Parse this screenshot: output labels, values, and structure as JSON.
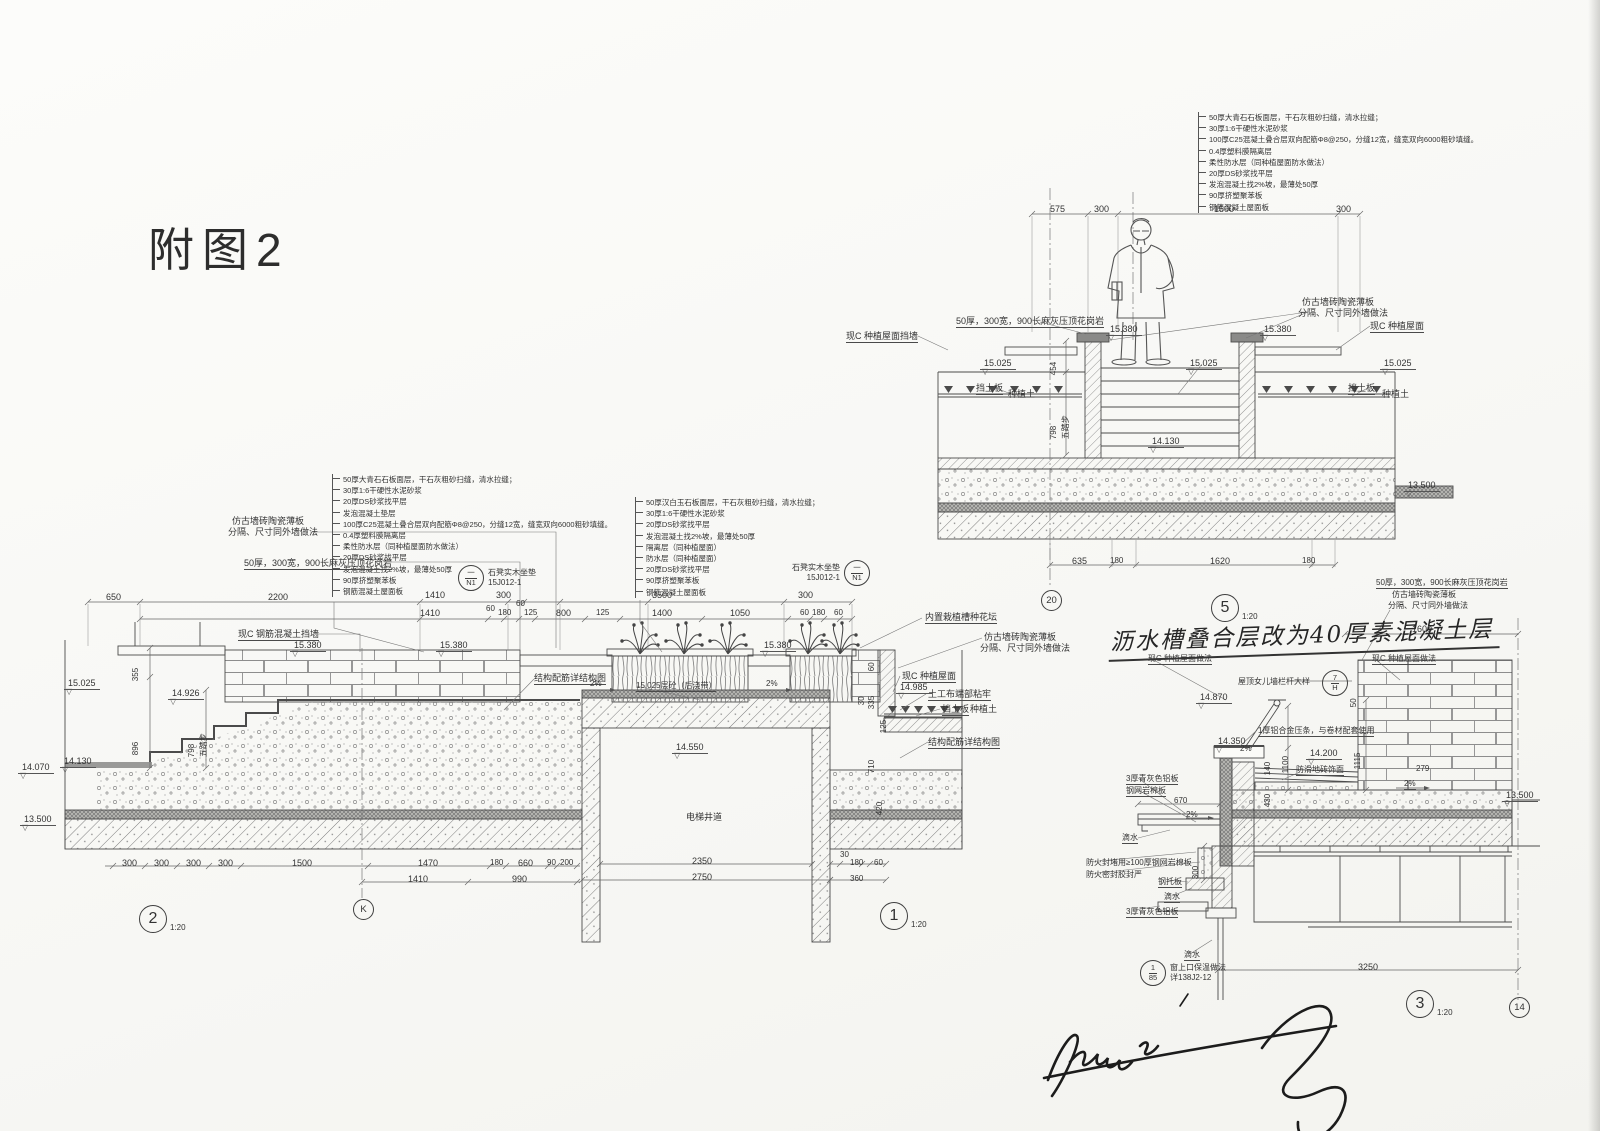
{
  "title": "附图2",
  "colors": {
    "paper": "#fbfbf8",
    "ink": "#4b4b4b",
    "ink_dark": "#2d2d2d"
  },
  "layer_stacks": {
    "stack_a": [
      "50厚大青石石板面层，干石灰粗砂扫缝，清水拉缝；",
      "30厚1:6干硬性水泥砂浆",
      "20厚DS砂浆找平层",
      "发泡混凝土垫层",
      "100厚C25混凝土叠合层双向配筋Φ8@250，分缝12宽，缝宽双向6000粗砂填缝。",
      "0.4厚塑料膜隔离层",
      "柔性防水层（同种植屋面防水做法）",
      "20厚DS砂浆找平层",
      "发泡混凝土找2%坡，最薄处50厚",
      "90厚挤塑聚苯板",
      "钢筋混凝土屋面板"
    ],
    "stack_b": [
      "50厚汉白玉石板面层，干石灰粗砂扫缝，清水拉缝；",
      "30厚1:6干硬性水泥砂浆",
      "20厚DS砂浆找平层",
      "发泡混凝土找2%坡，最薄处50厚",
      "隔离层（同种植屋面）",
      "防水层（同种植屋面）",
      "20厚DS砂浆找平层",
      "90厚挤塑聚苯板",
      "钢筋混凝土屋面板"
    ],
    "stack_c": [
      "50厚大青石石板面层，干石灰粗砂扫缝，清水拉缝；",
      "30厚1:6干硬性水泥砂浆",
      "100厚C25混凝土叠合层双向配筋Φ8@250，分缝12宽，缝宽双向6000粗砂填缝。",
      "0.4厚塑料膜隔离层",
      "柔性防水层（同种植屋面防水做法）",
      "20厚DS砂浆找平层",
      "发泡混凝土找2%坡，最薄处50厚",
      "90厚挤塑聚苯板",
      "钢筋混凝土屋面板"
    ]
  },
  "details": {
    "d2": {
      "num": "2",
      "scale": "1:20"
    },
    "d1": {
      "num": "1",
      "scale": "1:20"
    },
    "d5": {
      "num": "5",
      "scale": "1:20"
    },
    "d3": {
      "num": "3",
      "scale": "1:20"
    }
  },
  "grids": {
    "k": "K",
    "g20": "20",
    "g14": "14"
  },
  "callouts": {
    "bench": {
      "top": "一",
      "bottom": "N1",
      "label": "石凳实木坐垫",
      "ref": "15J012-1"
    },
    "parapet": {
      "top": "7",
      "bottom": "H"
    },
    "window": {
      "top": "1",
      "bottom": "85",
      "label": "窗上口保温做法",
      "ref": "详138J2-12"
    }
  },
  "note": {
    "text": "沥水槽叠合层改为40厚素混凝土层"
  },
  "annotations": [
    {
      "n": "dim",
      "t": "650",
      "x": 106,
      "y": 592
    },
    {
      "n": "dim",
      "t": "2200",
      "x": 268,
      "y": 592
    },
    {
      "n": "dim",
      "t": "1410",
      "x": 425,
      "y": 590
    },
    {
      "n": "dim",
      "t": "300",
      "x": 496,
      "y": 590
    },
    {
      "n": "dim",
      "t": "3500",
      "x": 652,
      "y": 590
    },
    {
      "n": "dim",
      "t": "300",
      "x": 798,
      "y": 590
    },
    {
      "n": "dim",
      "t": "1410",
      "x": 420,
      "y": 608
    },
    {
      "n": "dim",
      "t": "60",
      "x": 486,
      "y": 604,
      "c": "small"
    },
    {
      "n": "dim",
      "t": "180",
      "x": 498,
      "y": 608,
      "c": "small"
    },
    {
      "n": "dim",
      "t": "60",
      "x": 516,
      "y": 599,
      "c": "small"
    },
    {
      "n": "dim",
      "t": "125",
      "x": 524,
      "y": 608,
      "c": "small"
    },
    {
      "n": "dim",
      "t": "800",
      "x": 556,
      "y": 608
    },
    {
      "n": "dim",
      "t": "125",
      "x": 596,
      "y": 608,
      "c": "small"
    },
    {
      "n": "dim",
      "t": "1400",
      "x": 652,
      "y": 608
    },
    {
      "n": "dim",
      "t": "1050",
      "x": 730,
      "y": 608
    },
    {
      "n": "dim",
      "t": "60",
      "x": 800,
      "y": 608,
      "c": "small"
    },
    {
      "n": "dim",
      "t": "180",
      "x": 812,
      "y": 608,
      "c": "small"
    },
    {
      "n": "dim",
      "t": "60",
      "x": 834,
      "y": 608,
      "c": "small"
    },
    {
      "n": "label-tile-panel",
      "t": "仿古墙砖陶瓷薄板",
      "x": 232,
      "y": 516
    },
    {
      "n": "label-tile-panel",
      "t": "分隔、尺寸同外墙做法",
      "x": 228,
      "y": 527
    },
    {
      "n": "label-coping",
      "t": "50厚，300宽，900长麻灰压顶花岗岩",
      "x": 244,
      "y": 558,
      "c": "u"
    },
    {
      "n": "label-wall",
      "t": "现C 钢筋混凝土挡墙",
      "x": 238,
      "y": 629,
      "c": "u"
    },
    {
      "n": "elevation",
      "t": "15.380",
      "x": 290,
      "y": 640,
      "c": "elev"
    },
    {
      "n": "elevation",
      "t": "15.380",
      "x": 436,
      "y": 640,
      "c": "elev"
    },
    {
      "n": "elevation",
      "t": "15.380",
      "x": 760,
      "y": 640,
      "c": "elev"
    },
    {
      "n": "elevation",
      "t": "15.025",
      "x": 64,
      "y": 678,
      "c": "elev"
    },
    {
      "n": "elevation",
      "t": "14.926",
      "x": 168,
      "y": 688,
      "c": "elev"
    },
    {
      "n": "elevation",
      "t": "14.070",
      "x": 18,
      "y": 762,
      "c": "elev"
    },
    {
      "n": "elevation",
      "t": "14.130",
      "x": 60,
      "y": 756,
      "c": "elev"
    },
    {
      "n": "elevation",
      "t": "13.500",
      "x": 20,
      "y": 814,
      "c": "elev"
    },
    {
      "n": "elevation",
      "t": "14.550",
      "x": 672,
      "y": 742,
      "c": "elev"
    },
    {
      "n": "elevation",
      "t": "14.985",
      "x": 896,
      "y": 682,
      "c": "elev"
    },
    {
      "n": "dim",
      "t": "355",
      "x": 140,
      "y": 672,
      "c": "rot small"
    },
    {
      "n": "dim",
      "t": "896",
      "x": 140,
      "y": 746,
      "c": "rot small"
    },
    {
      "n": "dim",
      "t": "798",
      "x": 196,
      "y": 748,
      "c": "rot small"
    },
    {
      "n": "dim",
      "t": "五踏步",
      "x": 208,
      "y": 748,
      "c": "rot small"
    },
    {
      "n": "label-planter",
      "t": "内置栽植槽种花坛",
      "x": 925,
      "y": 612,
      "c": "u"
    },
    {
      "n": "label-tile-panel",
      "t": "仿古墙砖陶瓷薄板",
      "x": 984,
      "y": 632
    },
    {
      "n": "label-tile-panel",
      "t": "分隔、尺寸同外墙做法",
      "x": 980,
      "y": 643
    },
    {
      "n": "label-green-roof",
      "t": "现C 种植屋面",
      "x": 902,
      "y": 671,
      "c": "u"
    },
    {
      "n": "label-geotextile",
      "t": "土工布端部粘牢",
      "x": 928,
      "y": 689,
      "c": "u"
    },
    {
      "n": "label-soil-board",
      "t": "挡土板",
      "x": 942,
      "y": 704,
      "c": "u"
    },
    {
      "n": "label-soil",
      "t": "种植土",
      "x": 970,
      "y": 704
    },
    {
      "n": "label-rebar",
      "t": "结构配筋详结构图",
      "x": 928,
      "y": 737,
      "c": "u"
    },
    {
      "n": "label-rebar",
      "t": "结构配筋详结构图",
      "x": 534,
      "y": 673,
      "c": "u"
    },
    {
      "n": "label-pour-strip",
      "t": "15.025层砼（后浇带）",
      "x": 636,
      "y": 681,
      "c": "u small"
    },
    {
      "n": "slope",
      "t": "2%",
      "x": 590,
      "y": 679,
      "c": "small"
    },
    {
      "n": "slope",
      "t": "2%",
      "x": 766,
      "y": 679,
      "c": "small"
    },
    {
      "n": "elevator-shaft-label",
      "t": "电梯井道",
      "x": 686,
      "y": 812
    },
    {
      "n": "dim",
      "t": "335",
      "x": 876,
      "y": 700,
      "c": "rot small"
    },
    {
      "n": "dim",
      "t": "60",
      "x": 876,
      "y": 662,
      "c": "rot small"
    },
    {
      "n": "dim",
      "t": "30",
      "x": 866,
      "y": 696,
      "c": "rot small"
    },
    {
      "n": "dim",
      "t": "125",
      "x": 888,
      "y": 724,
      "c": "rot small"
    },
    {
      "n": "dim",
      "t": "710",
      "x": 876,
      "y": 764,
      "c": "rot small"
    },
    {
      "n": "dim",
      "t": "420",
      "x": 884,
      "y": 806,
      "c": "rot small"
    },
    {
      "n": "dim",
      "t": "300",
      "x": 122,
      "y": 858
    },
    {
      "n": "dim",
      "t": "300",
      "x": 154,
      "y": 858
    },
    {
      "n": "dim",
      "t": "300",
      "x": 186,
      "y": 858
    },
    {
      "n": "dim",
      "t": "300",
      "x": 218,
      "y": 858
    },
    {
      "n": "dim",
      "t": "1500",
      "x": 292,
      "y": 858
    },
    {
      "n": "dim",
      "t": "1470",
      "x": 418,
      "y": 858
    },
    {
      "n": "dim",
      "t": "180",
      "x": 490,
      "y": 858,
      "c": "small"
    },
    {
      "n": "dim",
      "t": "660",
      "x": 518,
      "y": 858
    },
    {
      "n": "dim",
      "t": "90",
      "x": 547,
      "y": 858,
      "c": "small"
    },
    {
      "n": "dim",
      "t": "200",
      "x": 560,
      "y": 858,
      "c": "small"
    },
    {
      "n": "dim",
      "t": "1410",
      "x": 408,
      "y": 874
    },
    {
      "n": "dim",
      "t": "990",
      "x": 512,
      "y": 874
    },
    {
      "n": "dim",
      "t": "2350",
      "x": 692,
      "y": 856
    },
    {
      "n": "dim",
      "t": "2750",
      "x": 692,
      "y": 872
    },
    {
      "n": "dim",
      "t": "30",
      "x": 840,
      "y": 850,
      "c": "small"
    },
    {
      "n": "dim",
      "t": "180",
      "x": 850,
      "y": 858,
      "c": "small"
    },
    {
      "n": "dim",
      "t": "60",
      "x": 874,
      "y": 858,
      "c": "small"
    },
    {
      "n": "dim",
      "t": "360",
      "x": 850,
      "y": 874,
      "c": "small"
    },
    {
      "n": "dim",
      "t": "575",
      "x": 1050,
      "y": 204
    },
    {
      "n": "dim",
      "t": "300",
      "x": 1094,
      "y": 204
    },
    {
      "n": "dim",
      "t": "1500",
      "x": 1214,
      "y": 204
    },
    {
      "n": "dim",
      "t": "300",
      "x": 1336,
      "y": 204
    },
    {
      "n": "label-coping",
      "t": "50厚，300宽，900长麻灰压顶花岗岩",
      "x": 956,
      "y": 316,
      "c": "u"
    },
    {
      "n": "elevation",
      "t": "15.380",
      "x": 1106,
      "y": 324,
      "c": "elev"
    },
    {
      "n": "elevation",
      "t": "15.380",
      "x": 1260,
      "y": 324,
      "c": "elev"
    },
    {
      "n": "elevation",
      "t": "15.025",
      "x": 980,
      "y": 358,
      "c": "elev"
    },
    {
      "n": "elevation",
      "t": "15.025",
      "x": 1186,
      "y": 358,
      "c": "elev"
    },
    {
      "n": "elevation",
      "t": "15.025",
      "x": 1380,
      "y": 358,
      "c": "elev"
    },
    {
      "n": "label-tile-panel",
      "t": "仿古墙砖陶瓷薄板",
      "x": 1302,
      "y": 297
    },
    {
      "n": "label-tile-panel",
      "t": "分隔、尺寸同外墙做法",
      "x": 1298,
      "y": 308
    },
    {
      "n": "label-wall",
      "t": "现C 种植屋面挡墙",
      "x": 846,
      "y": 331,
      "c": "u"
    },
    {
      "n": "label-green-roof",
      "t": "现C 种植屋面",
      "x": 1370,
      "y": 321,
      "c": "u"
    },
    {
      "n": "label-soil-board",
      "t": "挡土板",
      "x": 976,
      "y": 383,
      "c": "u"
    },
    {
      "n": "label-soil",
      "t": "种植土",
      "x": 1008,
      "y": 389
    },
    {
      "n": "label-soil-board",
      "t": "挡土板",
      "x": 1348,
      "y": 383,
      "c": "u"
    },
    {
      "n": "label-soil",
      "t": "种植土",
      "x": 1382,
      "y": 389
    },
    {
      "n": "dim",
      "t": "454",
      "x": 1058,
      "y": 366,
      "c": "rot small"
    },
    {
      "n": "dim",
      "t": "798",
      "x": 1058,
      "y": 430,
      "c": "rot small"
    },
    {
      "n": "dim",
      "t": "五踏步",
      "x": 1070,
      "y": 430,
      "c": "rot small"
    },
    {
      "n": "elevation",
      "t": "14.130",
      "x": 1148,
      "y": 436,
      "c": "elev"
    },
    {
      "n": "elevation",
      "t": "13.500",
      "x": 1404,
      "y": 480,
      "c": "elev"
    },
    {
      "n": "dim",
      "t": "635",
      "x": 1072,
      "y": 556
    },
    {
      "n": "dim",
      "t": "180",
      "x": 1110,
      "y": 556,
      "c": "small"
    },
    {
      "n": "dim",
      "t": "1620",
      "x": 1210,
      "y": 556
    },
    {
      "n": "dim",
      "t": "180",
      "x": 1302,
      "y": 556,
      "c": "small"
    },
    {
      "n": "label-coping",
      "t": "50厚，300宽，900长麻灰压顶花岗岩",
      "x": 1376,
      "y": 578,
      "c": "u small"
    },
    {
      "n": "label-tile-panel",
      "t": "仿古墙砖陶瓷薄板",
      "x": 1392,
      "y": 590,
      "c": "small"
    },
    {
      "n": "label-tile-panel",
      "t": "分隔、尺寸同外墙做法",
      "x": 1388,
      "y": 601,
      "c": "small"
    },
    {
      "n": "dim",
      "t": "1600",
      "x": 1412,
      "y": 624
    },
    {
      "n": "label-green-roof",
      "t": "现C 种植屋面做法",
      "x": 1148,
      "y": 654,
      "c": "u small"
    },
    {
      "n": "label-green-roof",
      "t": "现C 种植屋面做法",
      "x": 1372,
      "y": 654,
      "c": "u small"
    },
    {
      "n": "label-parapet",
      "t": "屋顶女儿墙栏杆大样",
      "x": 1238,
      "y": 677,
      "c": "small"
    },
    {
      "n": "elevation",
      "t": "14.870",
      "x": 1196,
      "y": 692,
      "c": "elev"
    },
    {
      "n": "dim",
      "t": "50",
      "x": 1358,
      "y": 698,
      "c": "rot small"
    },
    {
      "n": "label-al-strip",
      "t": "1厚铝合金压条，与卷材配套使用",
      "x": 1258,
      "y": 726,
      "c": "small u"
    },
    {
      "n": "elevation",
      "t": "14.350",
      "x": 1214,
      "y": 736,
      "c": "elev"
    },
    {
      "n": "slope",
      "t": "2%",
      "x": 1240,
      "y": 744,
      "c": "small"
    },
    {
      "n": "dim",
      "t": "1100",
      "x": 1290,
      "y": 764,
      "c": "rot small"
    },
    {
      "n": "dim",
      "t": "140",
      "x": 1272,
      "y": 766,
      "c": "rot small"
    },
    {
      "n": "elevation",
      "t": "14.200",
      "x": 1306,
      "y": 748,
      "c": "elev"
    },
    {
      "n": "label-tile",
      "t": "防滑地砖饰面",
      "x": 1296,
      "y": 765,
      "c": "small u"
    },
    {
      "n": "dim",
      "t": "430",
      "x": 1272,
      "y": 798,
      "c": "rot small"
    },
    {
      "n": "dim",
      "t": "1115",
      "x": 1362,
      "y": 760,
      "c": "rot small"
    },
    {
      "n": "dim",
      "t": "279",
      "x": 1416,
      "y": 764,
      "c": "small"
    },
    {
      "n": "slope",
      "t": "2%",
      "x": 1404,
      "y": 779,
      "c": "small u"
    },
    {
      "n": "label-al-plate",
      "t": "3厚青灰色铝板",
      "x": 1126,
      "y": 774,
      "c": "small u"
    },
    {
      "n": "label-rockwool",
      "t": "钢网岩棉板",
      "x": 1126,
      "y": 786,
      "c": "small u"
    },
    {
      "n": "dim",
      "t": "670",
      "x": 1174,
      "y": 796,
      "c": "small"
    },
    {
      "n": "slope",
      "t": "2%",
      "x": 1186,
      "y": 810,
      "c": "small"
    },
    {
      "n": "label-drip",
      "t": "滴水",
      "x": 1122,
      "y": 833,
      "c": "small u"
    },
    {
      "n": "dim",
      "t": "300",
      "x": 1200,
      "y": 870,
      "c": "rot small"
    },
    {
      "n": "label-fire-block",
      "t": "防火封堵用≥100厚钢网岩棉板",
      "x": 1086,
      "y": 858,
      "c": "small"
    },
    {
      "n": "label-fire-seal",
      "t": "防火密封胶封严",
      "x": 1086,
      "y": 870,
      "c": "small"
    },
    {
      "n": "label-steel-plate",
      "t": "钢托板",
      "x": 1158,
      "y": 877,
      "c": "small u"
    },
    {
      "n": "label-drip",
      "t": "滴水",
      "x": 1164,
      "y": 892,
      "c": "small u"
    },
    {
      "n": "label-al-plate",
      "t": "3厚青灰色铝板",
      "x": 1126,
      "y": 907,
      "c": "small u"
    },
    {
      "n": "label-drip",
      "t": "滴水",
      "x": 1184,
      "y": 950,
      "c": "small u"
    },
    {
      "n": "dim",
      "t": "3250",
      "x": 1358,
      "y": 962
    },
    {
      "n": "elevation",
      "t": "13.500",
      "x": 1502,
      "y": 790,
      "c": "elev"
    }
  ]
}
